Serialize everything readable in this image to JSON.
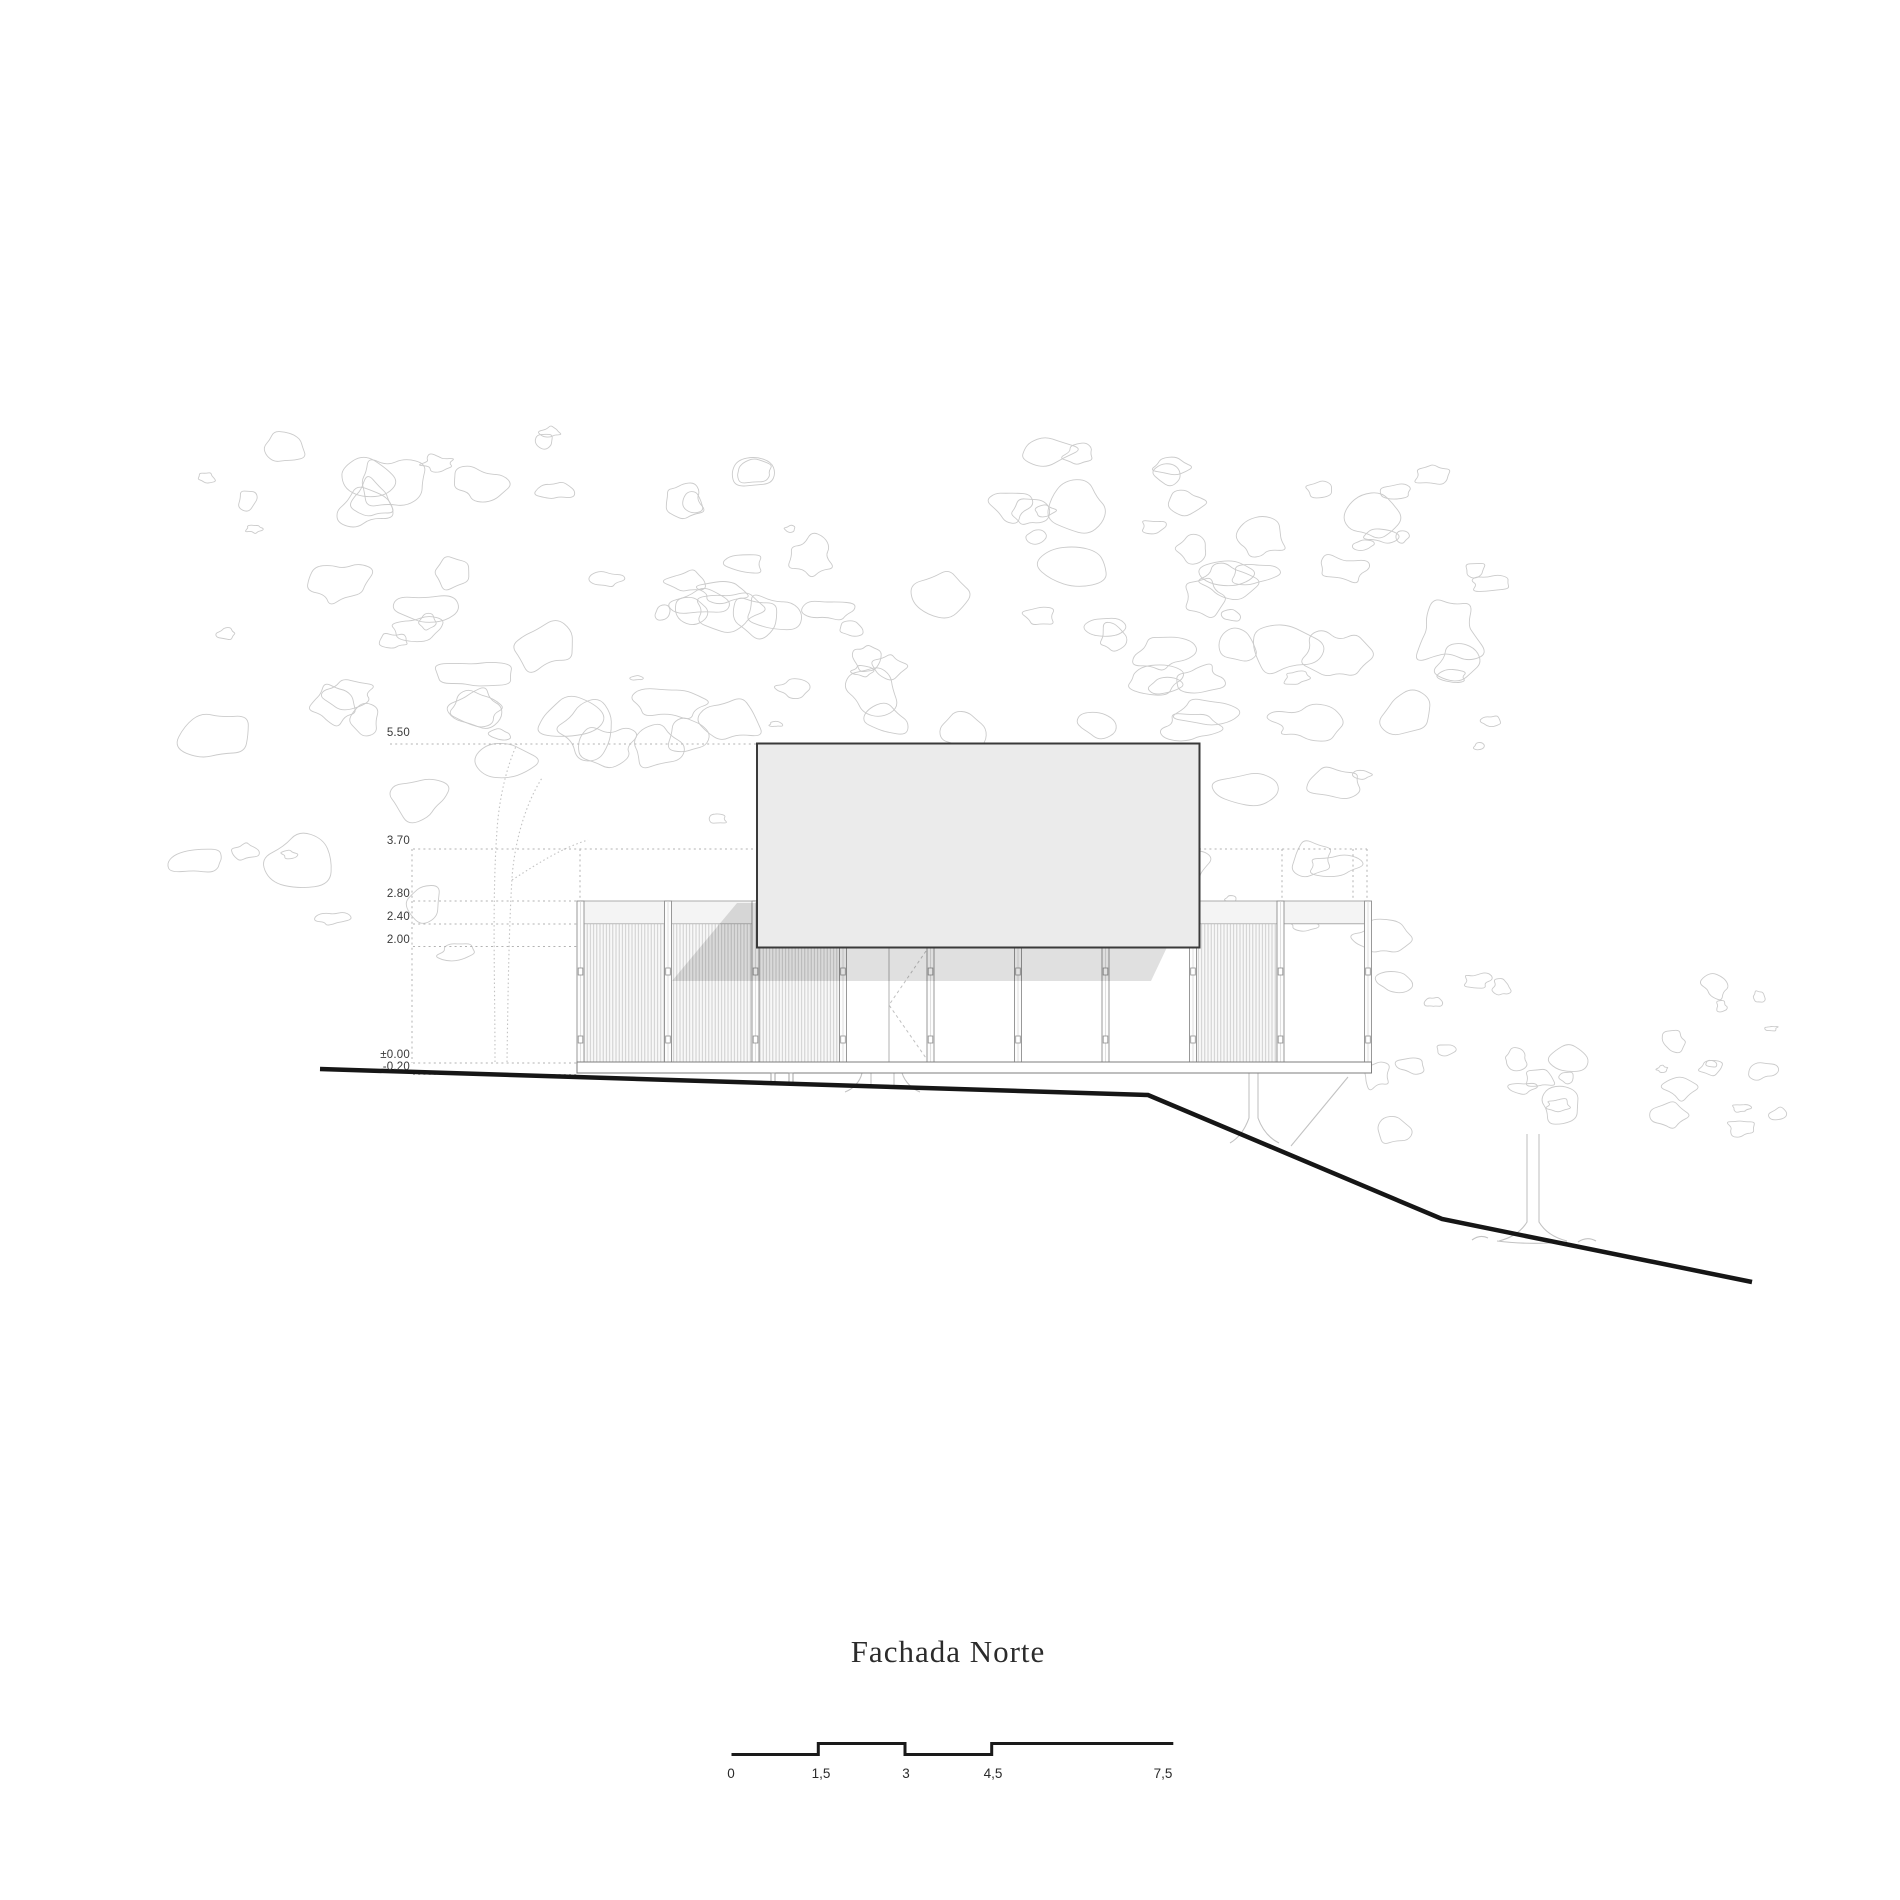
{
  "title": "Fachada Norte",
  "levels": [
    {
      "label": "5.50"
    },
    {
      "label": "3.70"
    },
    {
      "label": "2.80"
    },
    {
      "label": "2.40"
    },
    {
      "label": "2.00"
    },
    {
      "label": "±0.00"
    },
    {
      "label": "-0.20"
    }
  ],
  "scale_bar": {
    "labels": [
      "0",
      "1,5",
      "3",
      "4,5",
      "7,5"
    ]
  },
  "colors": {
    "background": "#ffffff",
    "label_text": "#3a3a3a",
    "title_text": "#2b2b2b",
    "roof_fill": "#ebebeb",
    "roof_border": "#3a3a3a",
    "band_fill": "#f4f4f4",
    "outline": "#9a9a9a",
    "post": "#8e8e8e",
    "hatch_line": "#c9c9c9",
    "hatch_bg": "#f8f8f8",
    "foliage": "#cbcbcb",
    "trunk": "#c2c2c2",
    "dashed_line": "#b3b3b3",
    "shadow": "rgba(0,0,0,0.12)",
    "ground_line": "#161616",
    "scale_bar_line": "#1a1a1a"
  }
}
